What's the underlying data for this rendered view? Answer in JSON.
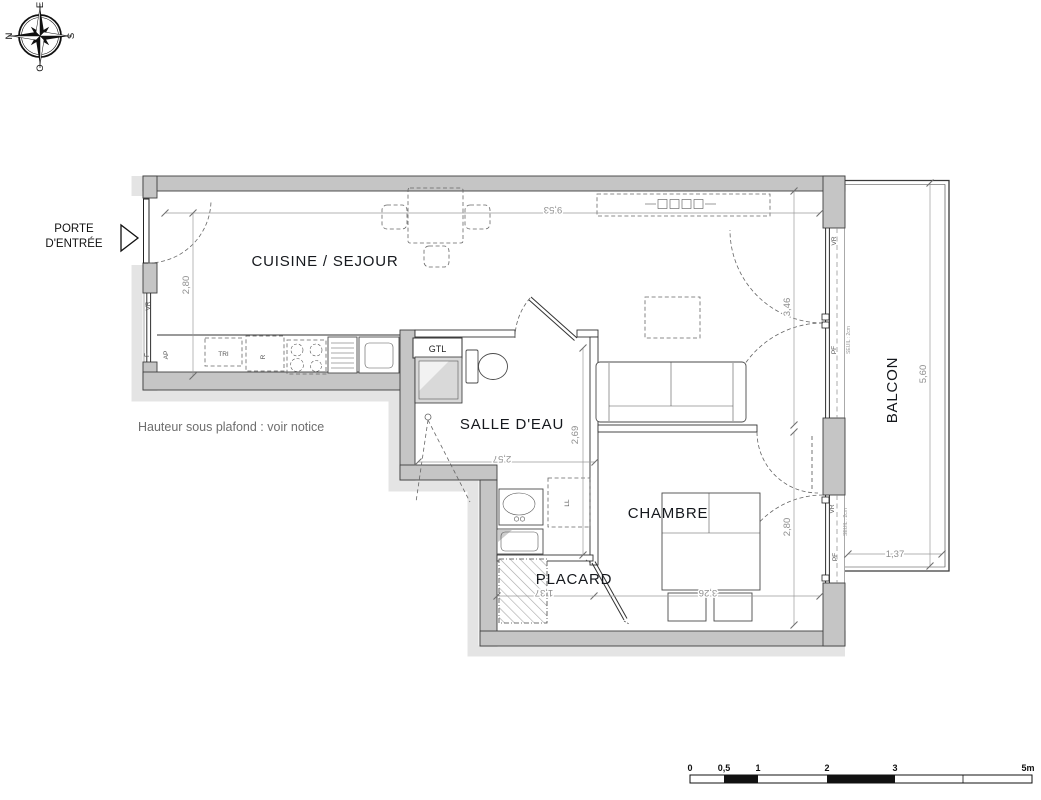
{
  "compass": {
    "n": "N",
    "s": "S",
    "e": "E",
    "o": "O"
  },
  "entrance": {
    "line1": "PORTE",
    "line2": "D'ENTRÉE"
  },
  "rooms": {
    "cuisine_sejour": "CUISINE / SEJOUR",
    "salle_deau": "SALLE D'EAU",
    "chambre": "CHAMBRE",
    "placard": "PLACARD",
    "balcon": "BALCON"
  },
  "ceiling_note": "Hauteur sous plafond : voir notice",
  "equipment": {
    "gtl": "GTL",
    "tri": "TRI",
    "fridge": "R",
    "washer": "LL"
  },
  "openings": {
    "vr": "VR",
    "f": "F",
    "ap": "AP",
    "pf": "PF",
    "seuil": "SEUIL : 2cm"
  },
  "dimensions": {
    "sejour_width": "9,53",
    "cuisine_depth": "2,80",
    "sejour_depth": "3,46",
    "sde_width": "2,57",
    "sde_depth": "2,69",
    "chambre_width": "3,26",
    "chambre_depth": "2,80",
    "placard_width": "1,37",
    "balcon_depth": "5,60",
    "balcon_width": "1,37"
  },
  "scale_bar": {
    "labels": [
      "0",
      "0,5",
      "1",
      "2",
      "3",
      "5m"
    ]
  },
  "colors": {
    "wall": "#c5c5c5",
    "wall_halo": "#e4e4e4",
    "dimension": "#8f8f8f",
    "label": "#15181d"
  }
}
